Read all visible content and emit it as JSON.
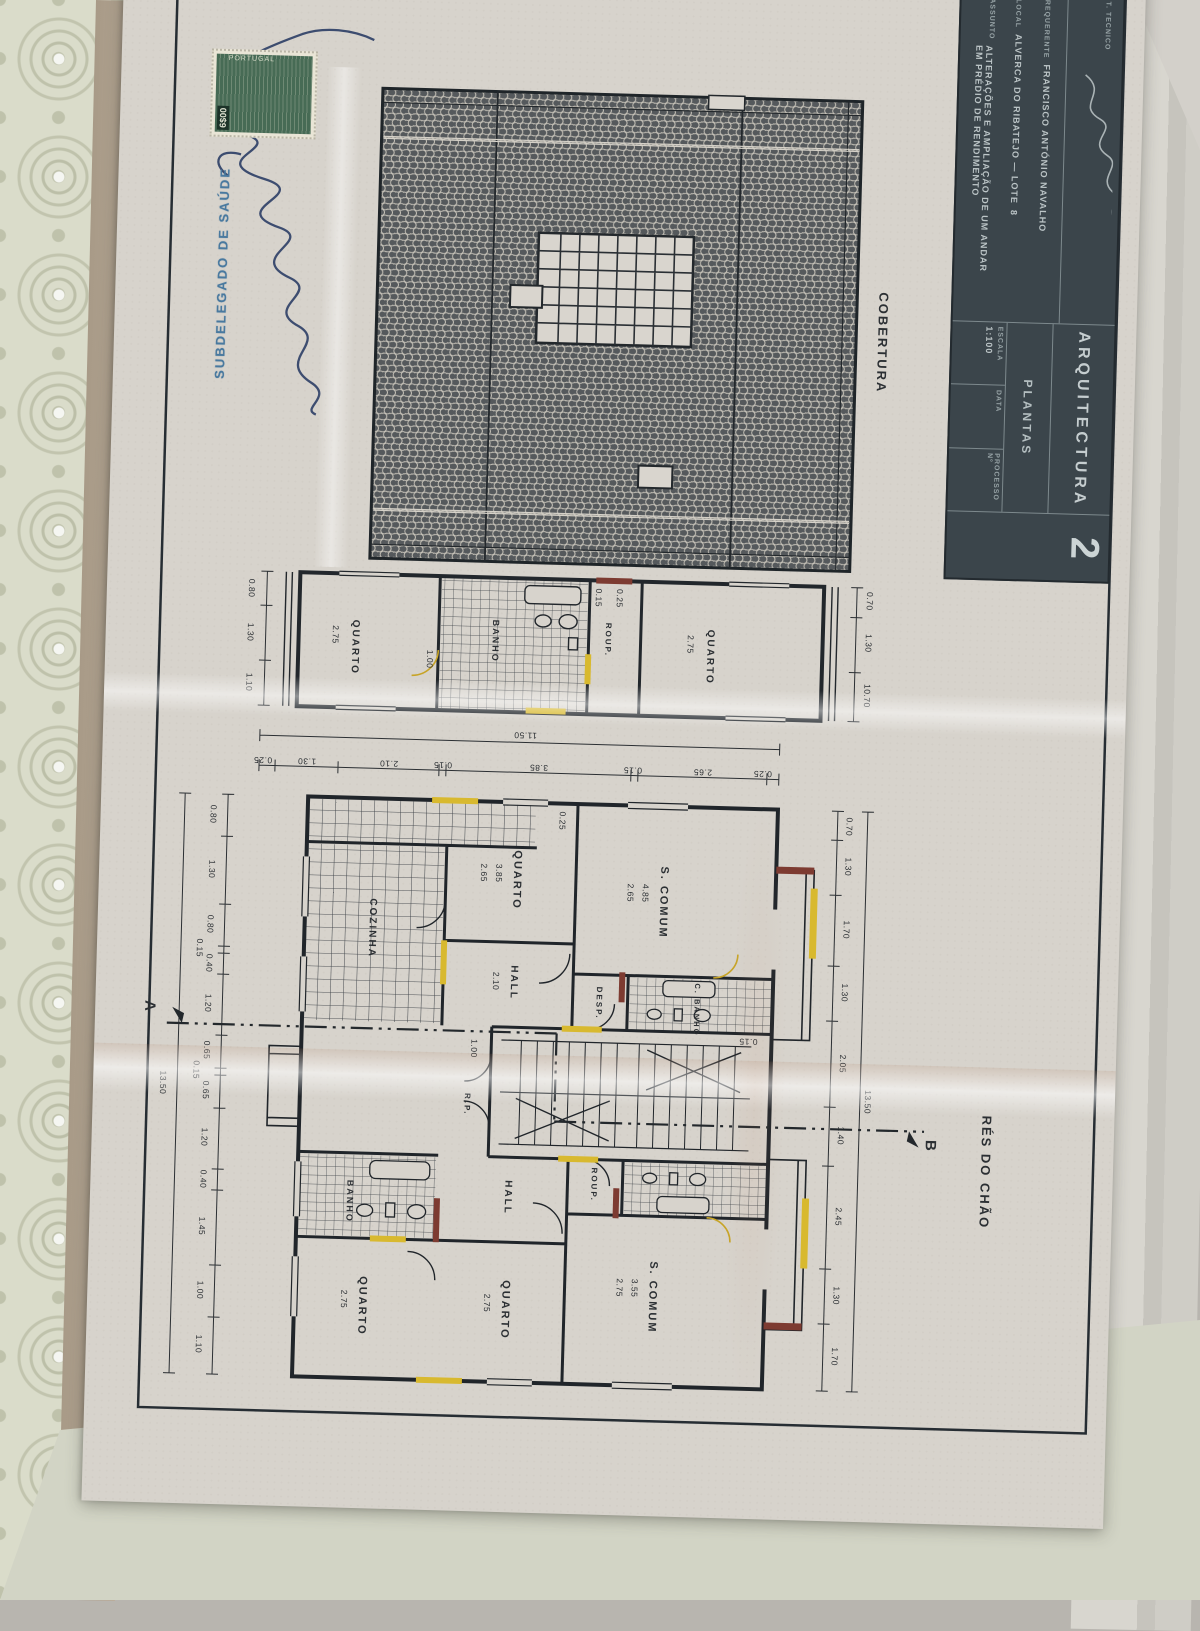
{
  "stamps": {
    "health": "SUBDELEGADO DE SAÚDE",
    "tax_value": "6$00",
    "tax_country": "PORTUGAL"
  },
  "title_block": {
    "technician_label": "T. TECNICO",
    "discipline": "ARQUITECTURA",
    "content": "PLANTAS",
    "scale_label": "ESCALA",
    "scale_value": "1:100",
    "date_label": "DATA",
    "process_label": "PROCESSO Nº",
    "sheet_number": "2",
    "requerente_label": "REQUERENTE",
    "requerente_value": "FRANCISCO ANTÓNIO NAVALHO",
    "local_label": "LOCAL",
    "local_value": "ALVERCA DO RIBATEJO — LOTE",
    "local_lot": "8",
    "assunto_label": "ASSUNTO",
    "assunto_line1": "ALTERAÇÕES E AMPLIAÇÃO DE UM ANDAR",
    "assunto_line2": "EM PRÉDIO DE RENDIMENTO"
  },
  "roof": {
    "label": "COBERTURA"
  },
  "floor": {
    "label": "RÉS DO CHÃO",
    "section_a": "A",
    "section_b": "B"
  },
  "rooms": {
    "quarto": "QUARTO",
    "banho": "BANHO",
    "cbanho": "C. BANHO",
    "desp": "DESP.",
    "roup": "ROUP.",
    "hall": "HALL",
    "scomum": "S. COMUM",
    "cozinha": "COZINHA",
    "rp": "R.P."
  },
  "dims": {
    "overall_w": "13.50",
    "overall_h": "11.50",
    "attic_overall": "10.70",
    "attic_width": "1.10",
    "top_chain": [
      "0.70",
      "1.30",
      "1.70",
      "1.30",
      "2.05",
      "1.40",
      "2.45",
      "1.30",
      "1.70"
    ],
    "bottom_chain": [
      "0.80",
      "1.30",
      "0.80",
      "0.15",
      "0.40",
      "1.20",
      "0.65",
      "0.15",
      "0.65",
      "1.20",
      "0.40",
      "1.45",
      "1.00",
      "1.10"
    ],
    "left_chain": [
      "0.25",
      "2.65",
      "0.15",
      "3.85",
      "0.15",
      "2.10",
      "1.30",
      "0.25"
    ],
    "attic_bottom": [
      "0.80",
      "1.30"
    ],
    "attic_top": [
      "0.70",
      "1.30"
    ],
    "room_dims": {
      "quarto_l": "3.85",
      "quarto_l2": "2.65",
      "scomum_l": "4.85",
      "scomum_l2": "2.65",
      "hall": "2.10",
      "scomum_r": "3.55",
      "scomum_r2": "2.75",
      "quarto_r": "2.75",
      "quarto_b": "2.75",
      "banho_b": "1.00",
      "attic_q1": "2.75",
      "attic_q2": "2.75",
      "small1": "0.15",
      "small2": "0.25",
      "small3": "1.00"
    }
  }
}
